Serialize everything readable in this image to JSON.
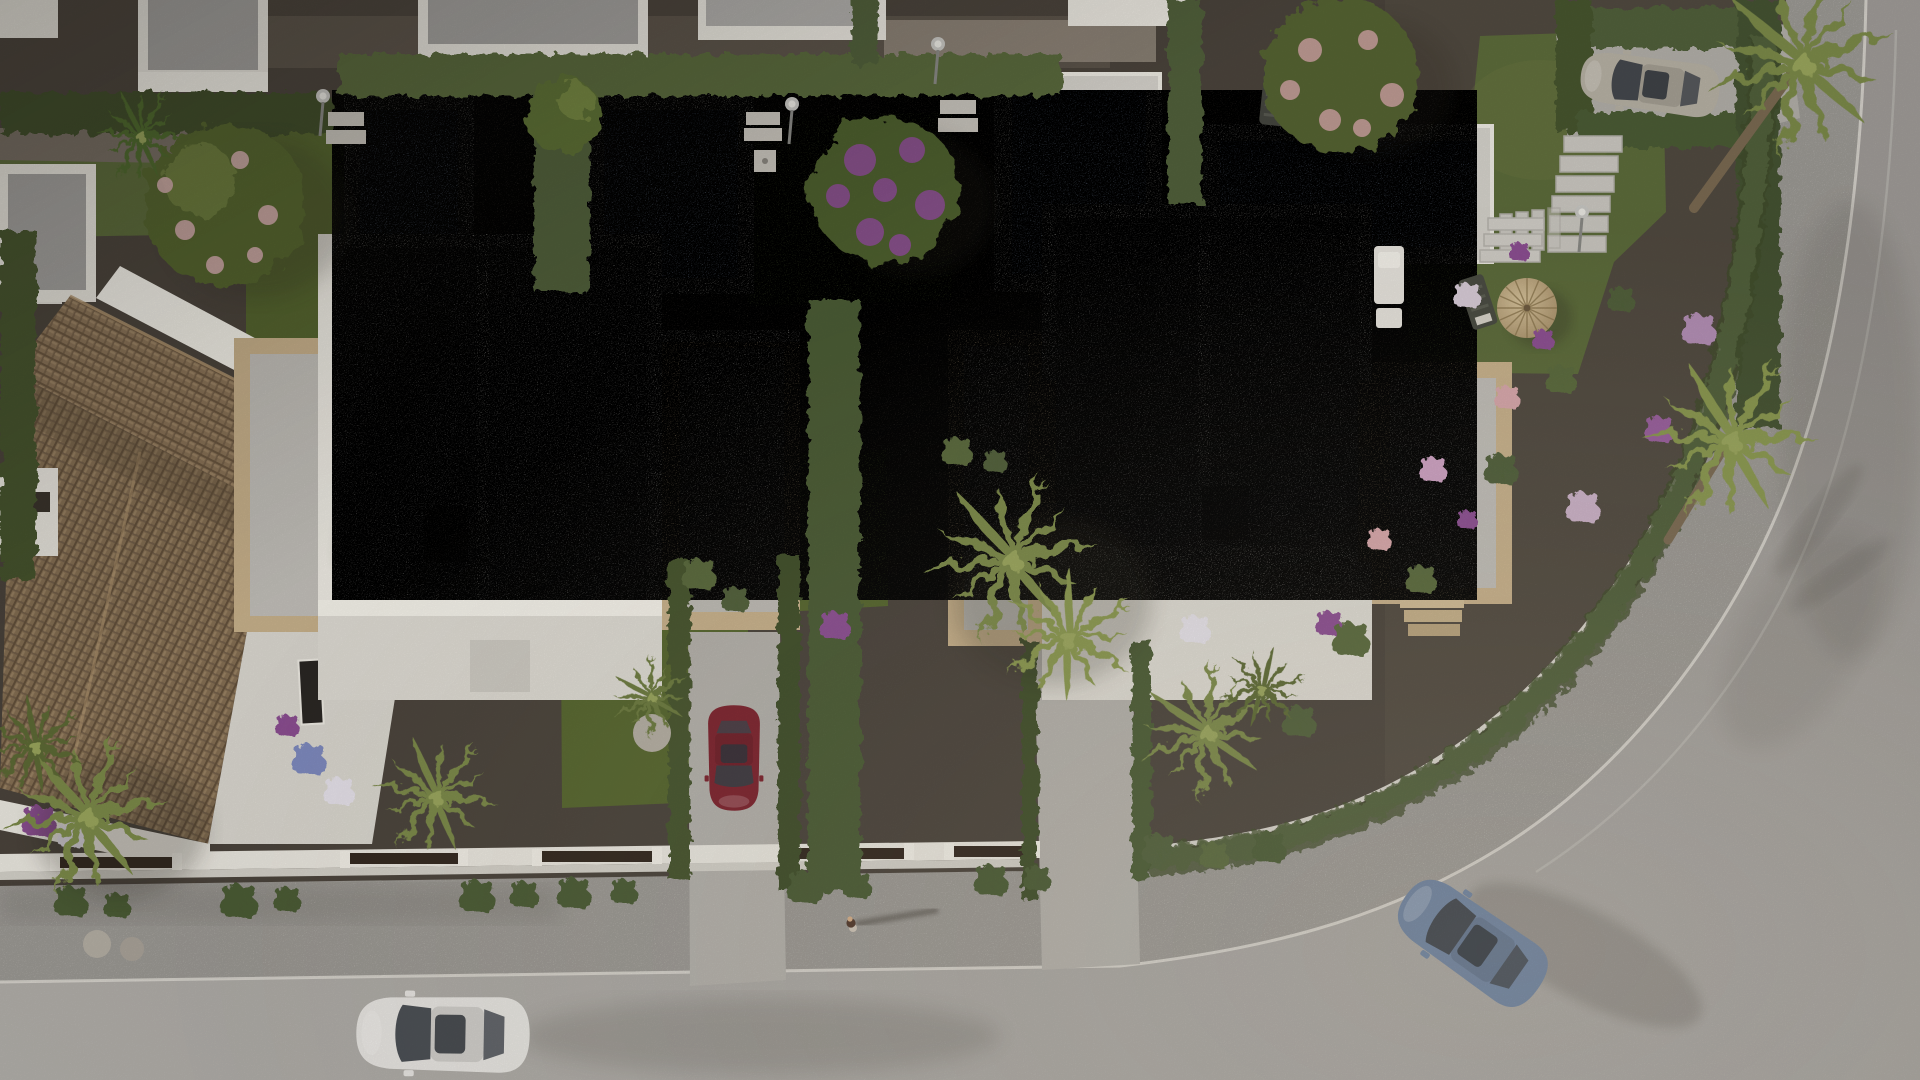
{
  "scene": {
    "description": "Aerial top-down 3D architectural render of a modern white-villa residential development with private pools, gravel gardens, hedges, palm trees and a curving street",
    "view": "top-down aerial",
    "lighting": "warm low-angle sunlight, long soft shadows toward the east"
  },
  "palette": {
    "ground_gravel": "#4b443c",
    "gravel_light": "#5a5248",
    "path_light": "#93897c",
    "road": "#a8a5a1",
    "road_light": "#b4b1ac",
    "sidewalk": "#bab7b1",
    "curb_white": "#dedbd4",
    "lane_line": "#c6c3bd",
    "wall_white": "#ece9e1",
    "wall_bright": "#f7f4ec",
    "wall_shade": "#dcd9d1",
    "roof_gray": "#a5a3a0",
    "roof_gray_light": "#b2b0ad",
    "ridge_white": "#efece4",
    "chimney_dark": "#56524c",
    "sandstone": "#c9b28c",
    "sandstone_light": "#dcca a6",
    "tile_brown": "#8b7458",
    "tile_brown_dark": "#6a563f",
    "tile_brown_light": "#9c8465",
    "pool_water": "#92a5c2",
    "pool_deck": "#d6d3cc",
    "grass": "#5d6c3b",
    "grass_dark": "#49592e",
    "hedge": "#51603a",
    "hedge_dark": "#3f4d2c",
    "palm_green": "#7c8a4a",
    "palm_dark": "#5d6b35",
    "flower_purple": "#8d4f93",
    "flower_pink": "#d9a8ac",
    "flower_white": "#e8e4ec",
    "stone_ball": "#b5afa4",
    "shadow": "#2e2a24",
    "gate_wood": "#33281f",
    "parasol": "#c7ab7e"
  },
  "street": {
    "road_color": "#a8a5a1",
    "sidewalk_color": "#bab7b1",
    "curb_color": "#dedbd4",
    "lane_line_color": "#c6c3bd",
    "lamps": 4
  },
  "vehicles": [
    {
      "id": "white-hatchback",
      "description": "white car driving west on the street",
      "color": "#e9e7e3"
    },
    {
      "id": "red-sedan",
      "description": "dark red car parked nose-in on a villa driveway",
      "color": "#7e232e"
    },
    {
      "id": "blue-sedan",
      "description": "blue-grey car rounding the corner",
      "color": "#6e83a1"
    },
    {
      "id": "grey-suv",
      "description": "grey SUV parked in the upper side driveway",
      "color": "#b7b1a4"
    }
  ],
  "buildings": {
    "villas": [
      {
        "id": "villa-left",
        "walls": "white",
        "roof": "flat grey gravel roof in two panels with dark chimney",
        "annexes": "sandstone-framed side terraces"
      },
      {
        "id": "villa-right",
        "walls": "white",
        "roof": "flat grey gravel roof in two panels with dark chimney",
        "annexes": "sandstone-framed side terraces"
      }
    ],
    "tiled_house": {
      "id": "house-tiled",
      "roof": "terracotta hip roof",
      "walls": "white"
    },
    "neighbor_houses_top_row": 5
  },
  "pools": {
    "count": 5,
    "water_color": "#92a5c2",
    "deck_color": "#d6d3cc"
  },
  "vegetation": {
    "palm_trees": 9,
    "flowering_trees": 3,
    "hedge_colors": [
      "#51603a",
      "#3f4d2c"
    ],
    "flower_colors": [
      "#8d4f93",
      "#d9a8ac",
      "#e8e4ec"
    ]
  },
  "amenities": {
    "sun_loungers": 2,
    "white_lounger": 1,
    "parasol_color": "#c7ab7e",
    "deck_chairs": 2,
    "stepping_stones": true,
    "garden_stairs": 2
  },
  "people": [
    {
      "id": "pedestrian",
      "description": "person walking east on the sidewalk"
    }
  ]
}
